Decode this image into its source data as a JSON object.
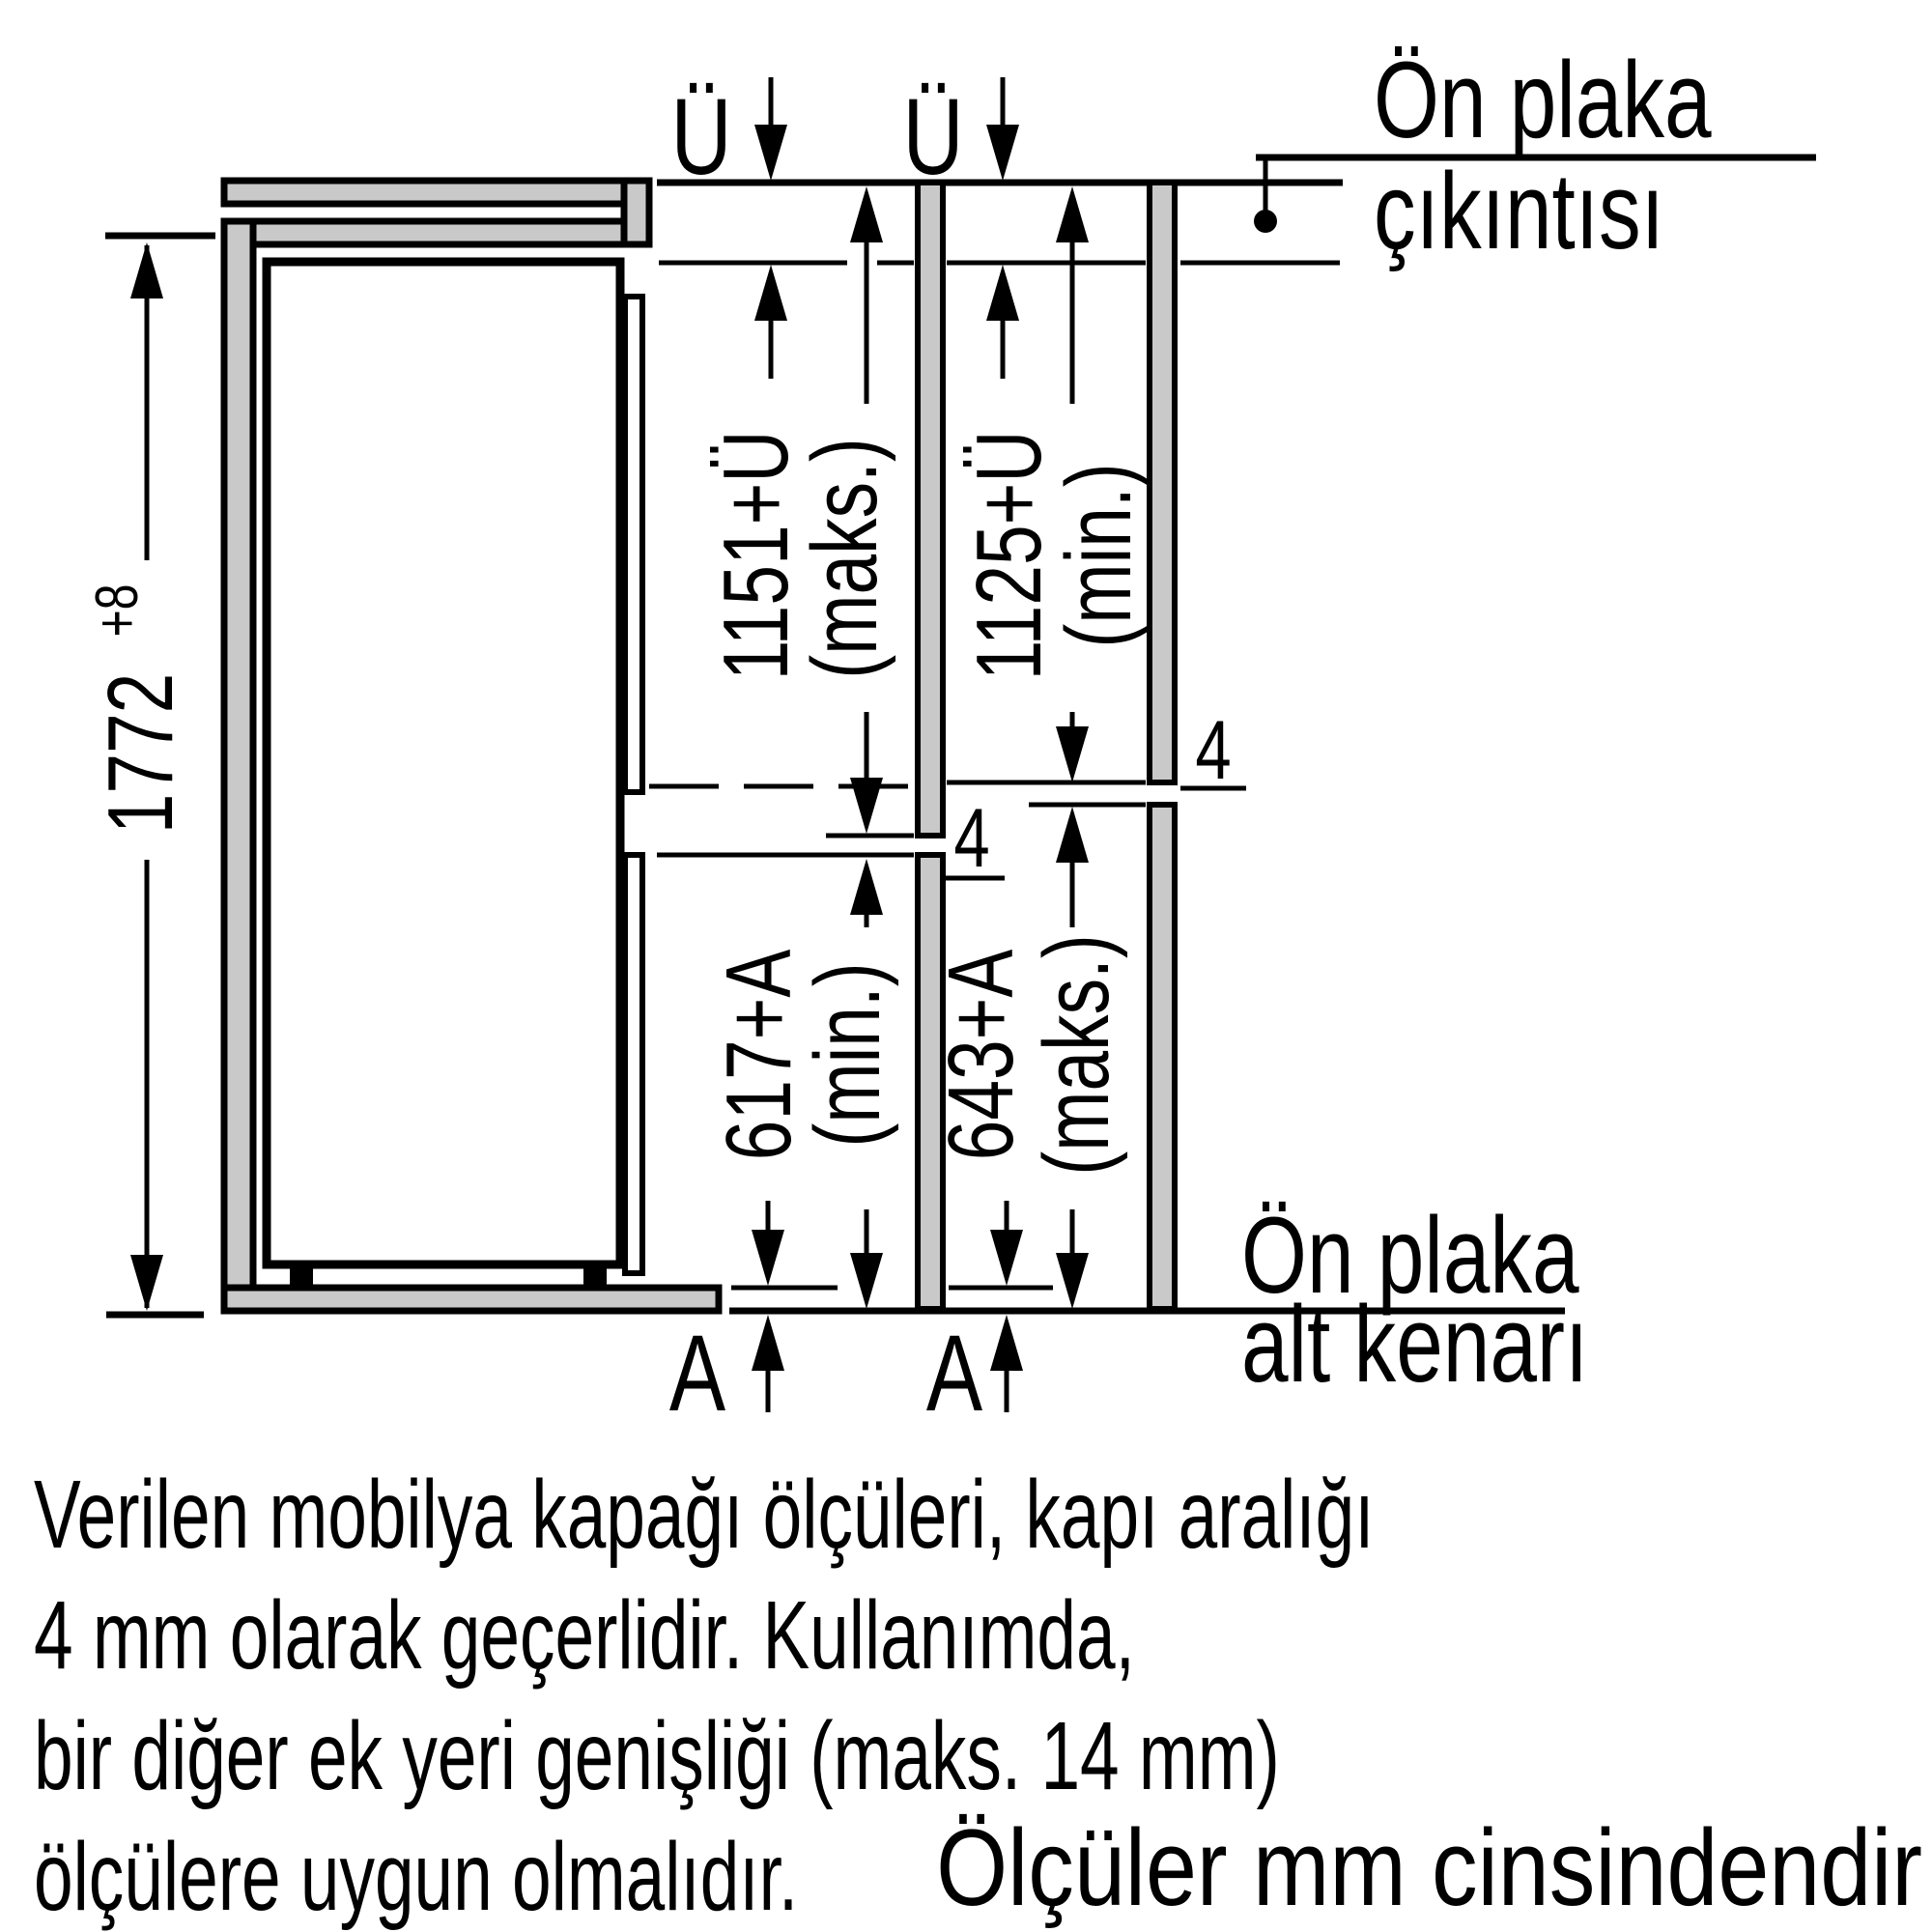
{
  "diagram": {
    "labels": {
      "u_left": "Ü",
      "u_right": "Ü",
      "overhang_line1": "Ön plaka",
      "overhang_line2": "çıkıntısı",
      "bottom_edge_line1": "Ön plaka",
      "bottom_edge_line2": "alt kenarı",
      "niche_height_value": "1772",
      "niche_height_tolerance": "+8",
      "dim_upper_left_value": "1151+Ü",
      "dim_upper_left_qualifier": "(maks.)",
      "dim_upper_right_value": "1125+Ü",
      "dim_upper_right_qualifier": "(min.)",
      "dim_lower_left_value": "617+A",
      "dim_lower_left_qualifier": "(min.)",
      "dim_lower_right_value": "643+A",
      "dim_lower_right_qualifier": "(maks.)",
      "gap_left": "4",
      "gap_right": "4",
      "adjust_left": "A",
      "adjust_right": "A"
    },
    "notes": {
      "paragraph": [
        "Verilen mobilya kapağı ölçüleri, kapı aralığı",
        "4 mm olarak geçerlidir. Kullanımda,",
        "bir diğer ek yeri genişliği (maks. 14 mm)",
        "ölçülere uygun olmalıdır."
      ],
      "units": "Ölçüler mm cinsindendir"
    },
    "colors": {
      "ink": "#000000",
      "panel_fill": "#c9c9c9",
      "background": "#ffffff"
    }
  }
}
